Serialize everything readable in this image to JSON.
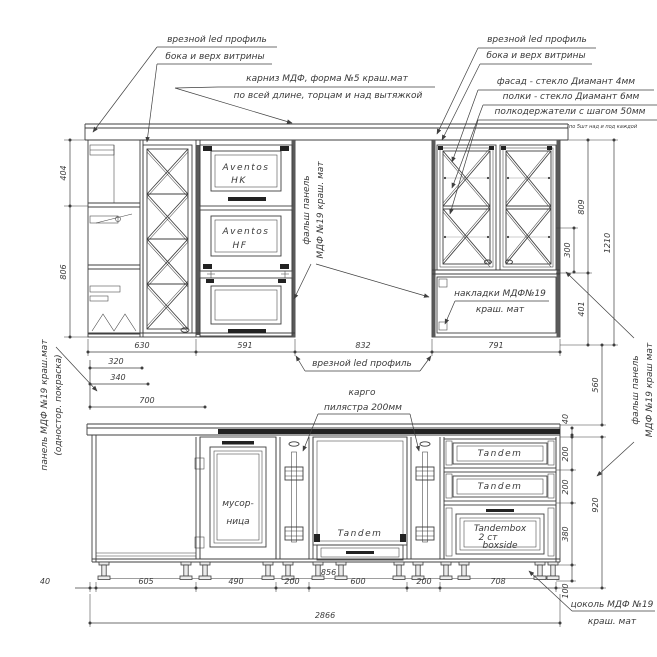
{
  "colors": {
    "line": "#3f3f3f",
    "dark": "#222222",
    "background": "#ffffff"
  },
  "annotations": {
    "led_left1": "врезной led профиль",
    "led_left2": "бока и верх витрины",
    "cornice1": "карниз МДФ, форма №5 краш.мат",
    "cornice2": "по всей длине, торцам и над вытяжкой",
    "led_right1": "врезной led профиль",
    "led_right2": "бока и верх витрины",
    "facade": "фасад - стекло Диамант 4мм",
    "shelves": "полки - стекло Диамант 6мм",
    "holders": "полкодержатели с шагом 50мм",
    "holders_note": "(по 5шт над и под каждой",
    "false_mid1": "фальш панель",
    "false_mid2": "МДФ №19 краш. мат",
    "onlay1": "накладки МДФ№19",
    "onlay2": "краш. мат",
    "led_mid": "врезной led профиль",
    "panel_left1": "панель МДФ №19 краш.мат",
    "panel_left2": "(одностор. покраска)",
    "false_right1": "фальш панель",
    "false_right2": "МДФ №19 краш мат",
    "cargo1": "карго",
    "cargo2": "пилястра 200мм",
    "plinth1": "цоколь МДФ №19",
    "plinth2": "краш. мат"
  },
  "labels": {
    "aventos1": "Aventos",
    "aventos1b": "HK",
    "aventos2": "Aventos",
    "aventos2b": "HF",
    "trash1": "мусор-",
    "trash2": "ница",
    "tandem_mid": "Tandem",
    "tandem_d1": "Tandem",
    "tandem_d2": "Tandem",
    "tbox1": "Tandembox",
    "tbox2": "2 ст",
    "tbox3": "boxside"
  },
  "dims": {
    "v404": "404",
    "v806": "806",
    "w630": "630",
    "w591": "591",
    "w832": "832",
    "w791": "791",
    "w320": "320",
    "w340": "340",
    "w700": "700",
    "r300": "300",
    "r809": "809",
    "r401": "401",
    "r1210": "1210",
    "r560": "560",
    "r40": "40",
    "r200a": "200",
    "r200b": "200",
    "r380": "380",
    "r100": "100",
    "r920": "920",
    "b40": "40",
    "b605": "605",
    "b490": "490",
    "b200a": "200",
    "b600": "600",
    "b200b": "200",
    "b708": "708",
    "plinth_len": "2856",
    "total": "2866"
  }
}
